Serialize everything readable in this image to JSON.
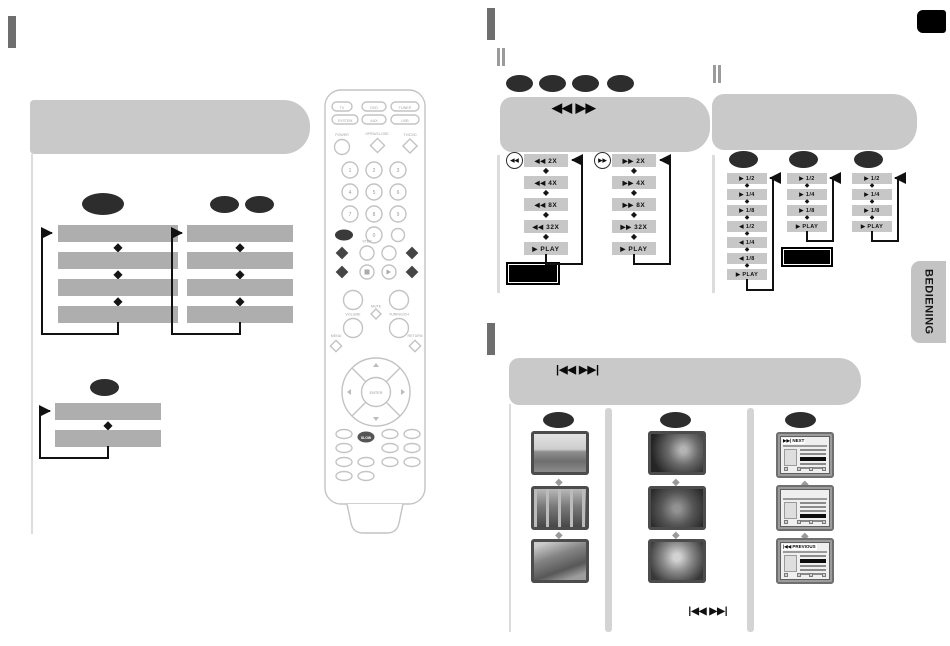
{
  "side_tab": {
    "label": "BEDIENING"
  },
  "search_section": {
    "header_icon": "◀◀ ▶▶",
    "rewind": {
      "icon": "◀◀",
      "steps": [
        "◀◀ 2X",
        "◀◀ 4X",
        "◀◀ 8X",
        "◀◀ 32X",
        "▶  PLAY"
      ]
    },
    "forward": {
      "icon": "▶▶",
      "steps": [
        "▶▶ 2X",
        "▶▶ 4X",
        "▶▶ 8X",
        "▶▶ 32X",
        "▶  PLAY"
      ]
    }
  },
  "slow_section": {
    "col1_steps": [
      "▶ 1/2",
      "▶ 1/4",
      "▶ 1/8",
      "◀ 1/2",
      "◀ 1/4",
      "◀ 1/8",
      "▶  PLAY"
    ],
    "col2_steps": [
      "▶ 1/2",
      "▶ 1/4",
      "▶ 1/8",
      "▶  PLAY"
    ],
    "col3_steps": [
      "▶ 1/2",
      "▶ 1/4",
      "▶ 1/8",
      "▶  PLAY"
    ]
  },
  "skip_section": {
    "header_icon": "|◀◀ ▶▶|",
    "next_label": "▶▶| NEXT",
    "previous_label": "|◀◀ PREVIOUS",
    "bottom_icon": "|◀◀ ▶▶|"
  },
  "remote": {
    "source_row1": [
      "TV",
      "DVD",
      "TUNER"
    ],
    "source_row2": [
      "SYSTEM",
      "AUX",
      "USB"
    ],
    "power_label": "POWER",
    "open_close_label": "OPEN/CLOSE",
    "tv_dvd_label": "TV/DVD",
    "digits": [
      "1",
      "2",
      "3",
      "4",
      "5",
      "6",
      "7",
      "8",
      "9",
      "0"
    ],
    "step_label": "STEP",
    "volume_label": "VOLUME",
    "mute_label": "MUTE",
    "tuning_label": "TUNING/CH",
    "menu_label": "MENU",
    "return_label": "RETURN",
    "enter_label": "ENTER",
    "slow_label": "SLOW"
  },
  "colors": {
    "callout_oval": "#2d2d2d",
    "header_gray": "#c9c9c9",
    "bar_gray": "#aeaeae",
    "marker_gray": "#6e6e6e"
  }
}
